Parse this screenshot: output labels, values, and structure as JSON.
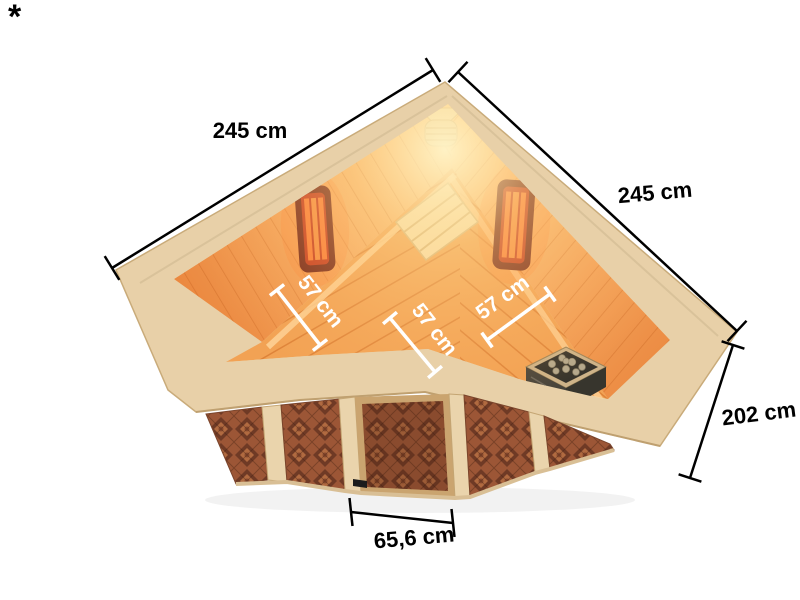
{
  "footnote": {
    "marker": "*"
  },
  "dimensions": {
    "width_left": "245 cm",
    "width_right": "245 cm",
    "height": "202 cm",
    "door_width": "65,6 cm",
    "bench_left": "57 cm",
    "bench_center": "57 cm",
    "bench_right": "57 cm"
  },
  "colors": {
    "background": "#ffffff",
    "dimension_line": "#000000",
    "interior_dimension_label": "#ffffff",
    "rim_wood": "#e8d0a8",
    "interior_wall_orange": "#f79a4c",
    "interior_glow": "#fff4c8",
    "bench_wood": "#f2a254",
    "heater_frame_red": "#6e1d12",
    "heater_glow_red": "#c13017",
    "heater_element_orange": "#ff7d33",
    "front_glass_bronze": "#9c5636",
    "glass_diamond_dark": "#6f3a25",
    "stove_metal_dark": "#33312a",
    "stove_stone_grey": "#b3a88d"
  }
}
